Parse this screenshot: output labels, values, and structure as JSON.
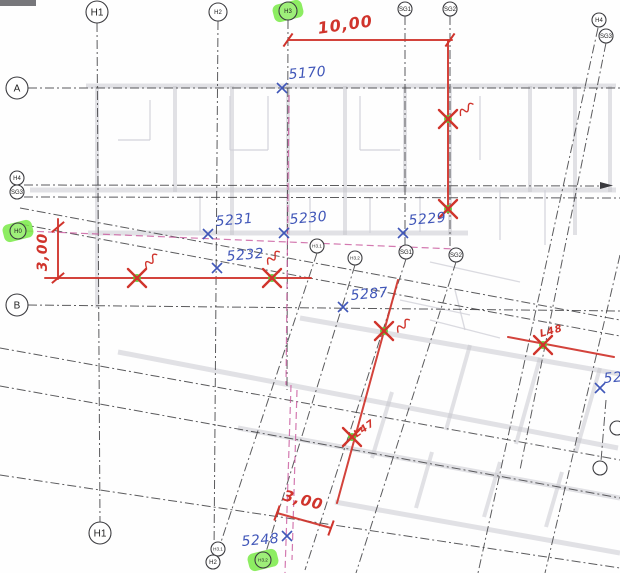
{
  "title": "scanned-floorplan-survey-markup",
  "colors": {
    "red": "#d0342c",
    "blue": "#4056b8",
    "grid": "#3f3f42",
    "magenta": "#c9589d",
    "green_blob": "#79ea46",
    "green_dot": "#52d433",
    "plan": "#c6c6cd",
    "plan_thin": "#d2d2d9",
    "bubble_stroke": "#3c3c40",
    "bubble_text": "#222222"
  },
  "bubbles": [
    {
      "x": 97,
      "y": 12,
      "r": 11,
      "label": "H1",
      "hl": false
    },
    {
      "x": 218,
      "y": 12,
      "r": 9,
      "label": "H2",
      "hl": false
    },
    {
      "x": 288,
      "y": 11,
      "r": 9,
      "label": "H3",
      "hl": true
    },
    {
      "x": 405,
      "y": 9,
      "r": 7,
      "label": "SG1",
      "hl": false
    },
    {
      "x": 450,
      "y": 9,
      "r": 7,
      "label": "SG2",
      "hl": false
    },
    {
      "x": 599,
      "y": 20,
      "r": 7,
      "label": "H4",
      "hl": false
    },
    {
      "x": 606,
      "y": 36,
      "r": 7,
      "label": "SG3",
      "hl": false
    },
    {
      "x": 17,
      "y": 88,
      "r": 11,
      "label": "A",
      "hl": false
    },
    {
      "x": 17,
      "y": 178,
      "r": 7,
      "label": "H4",
      "hl": false
    },
    {
      "x": 17,
      "y": 192,
      "r": 7,
      "label": "SG3",
      "hl": false
    },
    {
      "x": 18,
      "y": 231,
      "r": 8,
      "label": "H0",
      "hl": true
    },
    {
      "x": 17,
      "y": 305,
      "r": 11,
      "label": "B",
      "hl": false
    },
    {
      "x": 100,
      "y": 533,
      "r": 11,
      "label": "H1",
      "hl": false
    },
    {
      "x": 218,
      "y": 549,
      "r": 7,
      "label": "H3.1",
      "hl": false
    },
    {
      "x": 213,
      "y": 562,
      "r": 7,
      "label": "H2",
      "hl": false
    },
    {
      "x": 263,
      "y": 560,
      "r": 8,
      "label": "H3.2",
      "hl": true
    },
    {
      "x": 317,
      "y": 246,
      "r": 7,
      "label": "H3.1",
      "hl": false
    },
    {
      "x": 355,
      "y": 258,
      "r": 7,
      "label": "H3.2",
      "hl": false
    },
    {
      "x": 406,
      "y": 252,
      "r": 7,
      "label": "SG1",
      "hl": false
    },
    {
      "x": 456,
      "y": 255,
      "r": 7,
      "label": "SG2",
      "hl": false
    },
    {
      "x": 617,
      "y": 428,
      "r": 7,
      "label": "",
      "hl": false
    },
    {
      "x": 600,
      "y": 468,
      "r": 7,
      "label": "",
      "hl": false
    }
  ],
  "grid": {
    "black": [
      [
        97,
        23,
        100,
        522
      ],
      [
        218,
        21,
        214,
        555
      ],
      [
        288,
        20,
        287,
        390
      ],
      [
        405,
        16,
        405,
        245
      ],
      [
        450,
        16,
        450,
        248
      ],
      [
        606,
        400,
        601,
        461
      ],
      [
        28,
        88,
        620,
        88
      ],
      [
        24,
        185,
        605,
        186
      ],
      [
        24,
        197,
        620,
        198
      ],
      [
        28,
        305,
        620,
        311
      ],
      [
        20,
        208,
        620,
        320
      ],
      [
        20,
        224,
        620,
        336
      ],
      [
        0,
        348,
        620,
        460
      ],
      [
        0,
        386,
        620,
        498
      ],
      [
        0,
        475,
        620,
        568
      ],
      [
        317,
        253,
        221,
        542
      ],
      [
        355,
        265,
        266,
        552
      ],
      [
        406,
        259,
        305,
        570
      ],
      [
        456,
        262,
        356,
        573
      ],
      [
        598,
        28,
        478,
        573
      ],
      [
        606,
        43,
        520,
        470
      ],
      [
        620,
        255,
        545,
        573
      ]
    ],
    "magenta": [
      [
        26,
        231,
        455,
        249
      ],
      [
        289,
        95,
        286,
        385
      ],
      [
        291,
        385,
        285,
        573
      ],
      [
        297,
        390,
        292,
        560
      ]
    ]
  },
  "plan": {
    "bands": [
      [
        86,
        86,
        616,
        86
      ],
      [
        30,
        190,
        616,
        190
      ],
      [
        88,
        233,
        468,
        233
      ],
      [
        118,
        352,
        618,
        448
      ],
      [
        300,
        318,
        620,
        374
      ],
      [
        238,
        428,
        620,
        498
      ],
      [
        335,
        502,
        620,
        553
      ]
    ],
    "verticals": [
      [
        97,
        86,
        97,
        308
      ],
      [
        175,
        86,
        175,
        192
      ],
      [
        232,
        86,
        232,
        235
      ],
      [
        288,
        86,
        288,
        235
      ],
      [
        345,
        86,
        345,
        235
      ],
      [
        405,
        86,
        405,
        192
      ],
      [
        450,
        86,
        450,
        235
      ],
      [
        530,
        86,
        530,
        192
      ],
      [
        575,
        86,
        575,
        235
      ],
      [
        610,
        86,
        610,
        192
      ]
    ],
    "cross": [
      [
        470,
        345,
        446,
        430
      ],
      [
        540,
        358,
        516,
        444
      ],
      [
        600,
        368,
        576,
        452
      ],
      [
        392,
        392,
        372,
        458
      ],
      [
        432,
        452,
        416,
        508
      ],
      [
        500,
        462,
        484,
        517
      ],
      [
        562,
        472,
        546,
        527
      ]
    ],
    "thin": [
      [
        230,
        96,
        230,
        150
      ],
      [
        230,
        150,
        268,
        150
      ],
      [
        268,
        96,
        268,
        150
      ],
      [
        150,
        100,
        150,
        140
      ],
      [
        118,
        140,
        150,
        140
      ],
      [
        360,
        96,
        360,
        150
      ],
      [
        360,
        150,
        400,
        150
      ],
      [
        480,
        96,
        480,
        160
      ],
      [
        200,
        196,
        200,
        232
      ],
      [
        310,
        196,
        310,
        232
      ],
      [
        370,
        198,
        370,
        233
      ],
      [
        420,
        196,
        420,
        232
      ],
      [
        500,
        190,
        500,
        240
      ],
      [
        545,
        190,
        545,
        245
      ],
      [
        400,
        300,
        470,
        315
      ],
      [
        430,
        320,
        500,
        338
      ],
      [
        455,
        290,
        465,
        330
      ],
      [
        430,
        262,
        520,
        282
      ]
    ]
  },
  "red": {
    "lines": [
      [
        288,
        40,
        452,
        40
      ],
      [
        448,
        40,
        448,
        213
      ],
      [
        58,
        219,
        58,
        279
      ],
      [
        45,
        278,
        311,
        278
      ],
      [
        398,
        280,
        337,
        503
      ],
      [
        508,
        337,
        614,
        357
      ],
      [
        277,
        513,
        331,
        528
      ]
    ],
    "ticks": [
      {
        "x": 288,
        "y": 40,
        "rot": -55
      },
      {
        "x": 450,
        "y": 40,
        "rot": -55
      },
      {
        "x": 58,
        "y": 227,
        "rot": -40
      },
      {
        "x": 58,
        "y": 278,
        "rot": -40
      },
      {
        "x": 277,
        "y": 513,
        "rot": -70
      },
      {
        "x": 331,
        "y": 528,
        "rot": -70
      }
    ],
    "texts": [
      {
        "t": "10,00",
        "x": 346,
        "y": 30,
        "rot": -8,
        "fs": 16
      },
      {
        "t": "3,00",
        "x": 47,
        "y": 252,
        "rot": -90,
        "fs": 14
      },
      {
        "t": "3,00",
        "x": 302,
        "y": 505,
        "rot": 14,
        "fs": 15
      },
      {
        "t": "L48",
        "x": 552,
        "y": 334,
        "rot": -15,
        "fs": 10
      },
      {
        "t": "L47",
        "x": 366,
        "y": 431,
        "rot": -35,
        "fs": 10
      }
    ]
  },
  "markers": [
    {
      "x": 448,
      "y": 119,
      "sq": {
        "x": 458,
        "y": 110,
        "rot": -25
      }
    },
    {
      "x": 448,
      "y": 209
    },
    {
      "x": 137,
      "y": 278,
      "sq": {
        "x": 143,
        "y": 263,
        "rot": -35
      }
    },
    {
      "x": 272,
      "y": 278,
      "sq": {
        "x": 265,
        "y": 259,
        "rot": -30
      }
    },
    {
      "x": 384,
      "y": 331,
      "sq": {
        "x": 395,
        "y": 327,
        "rot": -30
      }
    },
    {
      "x": 543,
      "y": 345
    },
    {
      "x": 352,
      "y": 437
    }
  ],
  "points": [
    {
      "t": "5170",
      "tx": 289,
      "ty": 79,
      "mx": 282,
      "my": 88
    },
    {
      "t": "5231",
      "tx": 216,
      "ty": 226,
      "mx": 208,
      "my": 234
    },
    {
      "t": "5230",
      "tx": 290,
      "ty": 224,
      "mx": 284,
      "my": 233
    },
    {
      "t": "5229",
      "tx": 409,
      "ty": 225,
      "mx": 403,
      "my": 233
    },
    {
      "t": "5232",
      "tx": 227,
      "ty": 261,
      "mx": 217,
      "my": 268
    },
    {
      "t": "5287",
      "tx": 351,
      "ty": 300,
      "mx": 343,
      "my": 307
    },
    {
      "t": "5248",
      "tx": 242,
      "ty": 546,
      "mx": 287,
      "my": 536
    },
    {
      "t": "52",
      "tx": 604,
      "ty": 383,
      "mx": 600,
      "my": 388
    }
  ]
}
